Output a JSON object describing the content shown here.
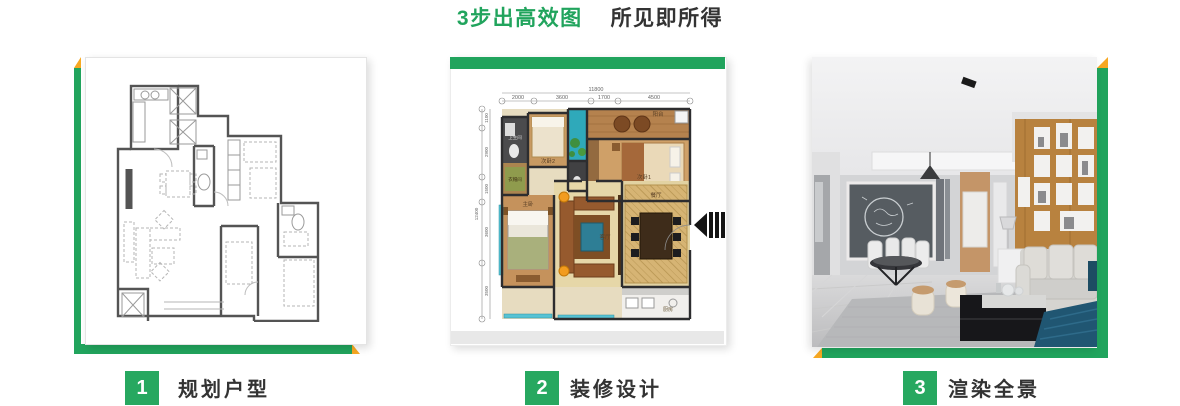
{
  "title": {
    "highlight": "3步出高效图",
    "rest": "所见即所得"
  },
  "steps": [
    {
      "number": "1",
      "label": "规划户型"
    },
    {
      "number": "2",
      "label": "装修设计"
    },
    {
      "number": "3",
      "label": "渲染全景"
    }
  ],
  "colors": {
    "accent_green": "#21A45D",
    "badge_green": "#27A860",
    "accent_yellow": "#F7A823",
    "text_dark": "#333333"
  },
  "panel2": {
    "dims_top": [
      "2000",
      "3600",
      "1700",
      "4500"
    ],
    "dims_top_total": "11800",
    "dims_left": [
      "1100",
      "2900",
      "1500",
      "3600",
      "3500"
    ],
    "dims_left_total": "12400",
    "rooms": {
      "balcony": "阳台",
      "bedroom1": "次卧1",
      "bedroom2": "次卧2",
      "bath": "卫生间",
      "cloak": "衣帽间",
      "master": "主卧",
      "living": "客厅",
      "dining": "餐厅",
      "kitchen": "厨房"
    }
  },
  "icons": {
    "entrance": "entrance-arrow-icon"
  }
}
